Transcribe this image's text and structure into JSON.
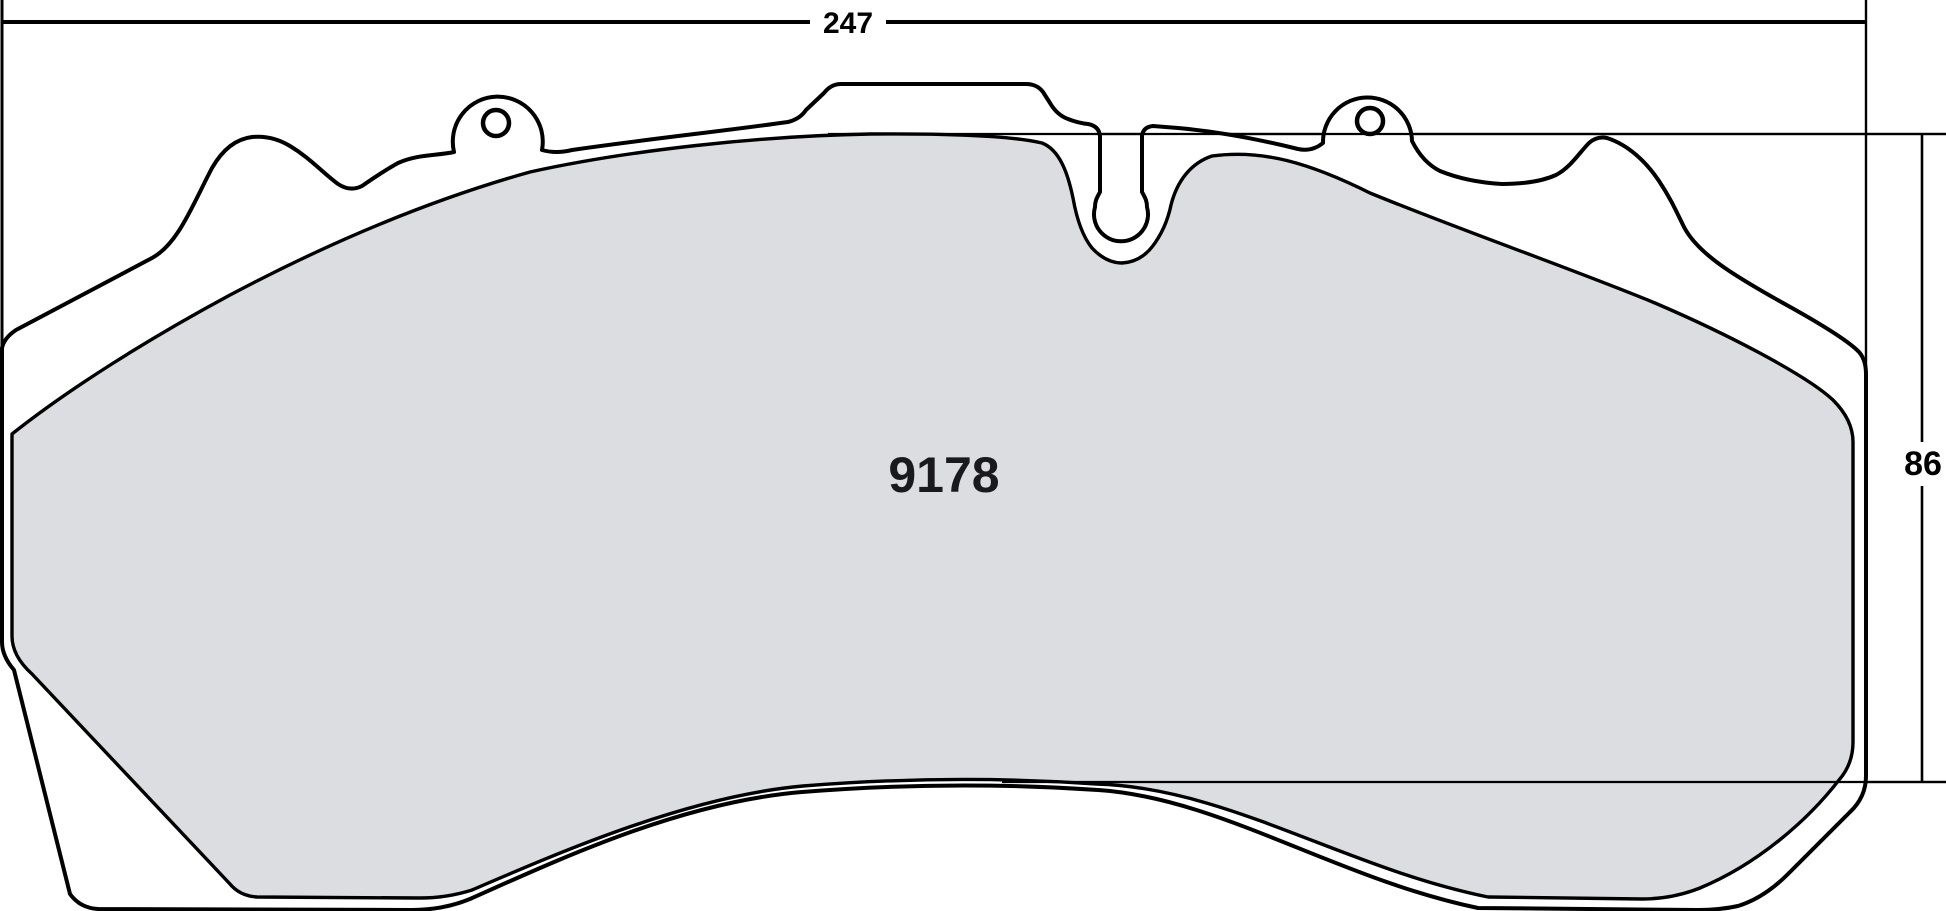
{
  "drawing": {
    "title": "brake-pad-dimensional-drawing",
    "part_number": "9178",
    "dimensions": {
      "width_label": "247",
      "height_label": "86"
    },
    "colors": {
      "line": "#000000",
      "friction_fill": "#dcdde0",
      "background": "#ffffff"
    }
  }
}
